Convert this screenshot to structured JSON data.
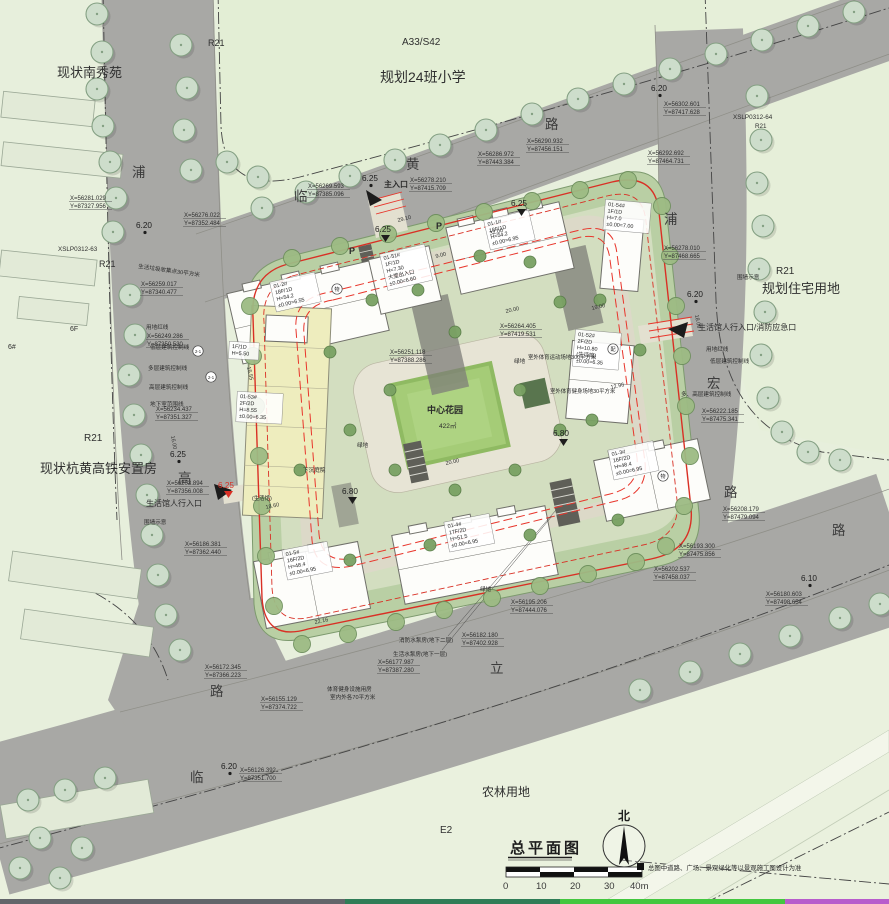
{
  "doc": {
    "title": "总平面图",
    "north_label": "北",
    "note": "总图中道路、广场、景观绿化等以景观施工图设计为准"
  },
  "scalebar": {
    "labels": [
      "0",
      "10",
      "20",
      "30",
      "40m"
    ]
  },
  "parcel_labels": [
    {
      "t": "R21",
      "x": 208,
      "y": 46,
      "s": 9
    },
    {
      "t": "现状南秀苑",
      "x": 57,
      "y": 77,
      "s": 13
    },
    {
      "t": "A33/S42",
      "x": 402,
      "y": 45,
      "s": 10
    },
    {
      "t": "规划24班小学",
      "x": 380,
      "y": 82,
      "s": 14
    },
    {
      "t": "XSLP0312-64",
      "x": 733,
      "y": 119,
      "s": 6.3
    },
    {
      "t": "R21",
      "x": 755,
      "y": 128,
      "s": 6.3
    },
    {
      "t": "R21",
      "x": 776,
      "y": 274,
      "s": 10
    },
    {
      "t": "规划住宅用地",
      "x": 762,
      "y": 293,
      "s": 13
    },
    {
      "t": "XSLP0312-63",
      "x": 58,
      "y": 251,
      "s": 6.3
    },
    {
      "t": "R21",
      "x": 99,
      "y": 267,
      "s": 9
    },
    {
      "t": "6F",
      "x": 70,
      "y": 331,
      "s": 7
    },
    {
      "t": "6#",
      "x": 8,
      "y": 349,
      "s": 7
    },
    {
      "t": "R21",
      "x": 84,
      "y": 441,
      "s": 10
    },
    {
      "t": "现状杭黄高铁安置房",
      "x": 40,
      "y": 473,
      "s": 13
    },
    {
      "t": "农林用地",
      "x": 482,
      "y": 796,
      "s": 12
    },
    {
      "t": "E2",
      "x": 440,
      "y": 833,
      "s": 10
    }
  ],
  "road_labels": [
    {
      "t": "浦",
      "x": 132,
      "y": 177
    },
    {
      "t": "临",
      "x": 294,
      "y": 201
    },
    {
      "t": "黄",
      "x": 406,
      "y": 169
    },
    {
      "t": "路",
      "x": 545,
      "y": 129
    },
    {
      "t": "浦",
      "x": 664,
      "y": 224
    },
    {
      "t": "宏",
      "x": 707,
      "y": 388
    },
    {
      "t": "路",
      "x": 724,
      "y": 497
    },
    {
      "t": "路",
      "x": 832,
      "y": 535
    },
    {
      "t": "高",
      "x": 178,
      "y": 483
    },
    {
      "t": "路",
      "x": 210,
      "y": 696
    },
    {
      "t": "临",
      "x": 190,
      "y": 782
    },
    {
      "t": "立",
      "x": 490,
      "y": 673
    }
  ],
  "annotations": [
    {
      "t": "主入口",
      "x": 384,
      "y": 187,
      "s": 8,
      "b": 1
    },
    {
      "t": "生活馆人行入口/消防应急口",
      "x": 698,
      "y": 330,
      "s": 8
    },
    {
      "t": "生活馆人行入口",
      "x": 146,
      "y": 506,
      "s": 8
    },
    {
      "t": "生活垃圾收集点30平方米",
      "x": 138,
      "y": 268,
      "s": 5.6,
      "r": 8
    },
    {
      "t": "用地红线",
      "x": 146,
      "y": 329,
      "s": 5.6
    },
    {
      "t": "低层建筑控制线",
      "x": 150,
      "y": 349,
      "s": 5.6
    },
    {
      "t": "多层建筑控制线",
      "x": 148,
      "y": 370,
      "s": 5.6
    },
    {
      "t": "高层建筑控制线",
      "x": 149,
      "y": 389,
      "s": 5.6
    },
    {
      "t": "地下室范围线",
      "x": 150,
      "y": 406,
      "s": 5.6
    },
    {
      "t": "用地红线",
      "x": 706,
      "y": 351,
      "s": 5.6
    },
    {
      "t": "低层建筑控制线",
      "x": 710,
      "y": 363,
      "s": 5.6
    },
    {
      "t": "多、高层建筑控制线",
      "x": 681,
      "y": 396,
      "s": 5.6
    },
    {
      "t": "围墙示意",
      "x": 737,
      "y": 279,
      "s": 5.6
    },
    {
      "t": "围墙示意",
      "x": 144,
      "y": 524,
      "s": 5.6
    },
    {
      "t": "室外体育运动场地300平方米",
      "x": 528,
      "y": 359,
      "s": 5.4
    },
    {
      "t": "室外体育健身场地30平方米",
      "x": 550,
      "y": 393,
      "s": 5.4
    },
    {
      "t": "体育健身设施用房",
      "x": 327,
      "y": 691,
      "s": 5.6
    },
    {
      "t": "室内外各70平方米",
      "x": 330,
      "y": 699,
      "s": 5.6
    },
    {
      "t": "消防水泵房(地下二层)",
      "x": 399,
      "y": 642,
      "s": 5.6
    },
    {
      "t": "生活水泵房(地下一层)",
      "x": 393,
      "y": 656,
      "s": 5.6
    },
    {
      "t": "下沉庭院",
      "x": 303,
      "y": 472,
      "s": 5.6
    },
    {
      "t": "中心花园",
      "x": 427,
      "y": 413,
      "s": 9,
      "b": 1
    },
    {
      "t": "422㎡",
      "x": 439,
      "y": 428,
      "s": 6.5
    },
    {
      "t": "绿地",
      "x": 514,
      "y": 363,
      "s": 5.6
    },
    {
      "t": "绿地",
      "x": 357,
      "y": 447,
      "s": 5.6
    },
    {
      "t": "绿地",
      "x": 480,
      "y": 591,
      "s": 5.6
    },
    {
      "t": "(生活馆)",
      "x": 252,
      "y": 500,
      "s": 5.4
    },
    {
      "t": "P",
      "x": 349,
      "y": 254,
      "s": 9,
      "b": 1
    },
    {
      "t": "P",
      "x": 436,
      "y": 229,
      "s": 9,
      "b": 1
    }
  ],
  "dimensions": [
    {
      "t": "29.10",
      "x": 398,
      "y": 222,
      "r": -14
    },
    {
      "t": "32.00",
      "x": 490,
      "y": 235,
      "r": -14
    },
    {
      "t": "9.00",
      "x": 436,
      "y": 258,
      "r": -14
    },
    {
      "t": "15.55",
      "x": 247,
      "y": 367,
      "r": 78
    },
    {
      "t": "20.00",
      "x": 506,
      "y": 313,
      "r": -13
    },
    {
      "t": "19.00",
      "x": 592,
      "y": 310,
      "r": -13
    },
    {
      "t": "20.00",
      "x": 446,
      "y": 465,
      "r": -13
    },
    {
      "t": "22.16",
      "x": 315,
      "y": 624,
      "r": -12
    },
    {
      "t": "18.60",
      "x": 266,
      "y": 509,
      "r": -12
    },
    {
      "t": "18.00",
      "x": 695,
      "y": 315,
      "r": 80
    },
    {
      "t": "16.00",
      "x": 171,
      "y": 436,
      "r": 80
    },
    {
      "t": "12.96",
      "x": 611,
      "y": 389,
      "r": -12
    }
  ],
  "elevations": [
    {
      "t": "6.20",
      "x": 136,
      "y": 228
    },
    {
      "t": "6.25",
      "x": 362,
      "y": 181
    },
    {
      "t": "6.20",
      "x": 651,
      "y": 91
    },
    {
      "t": "6.20",
      "x": 687,
      "y": 297
    },
    {
      "t": "6.20",
      "x": 221,
      "y": 769
    },
    {
      "t": "6.10",
      "x": 801,
      "y": 581
    },
    {
      "t": "6.25",
      "x": 170,
      "y": 457
    },
    {
      "t": "6.25",
      "x": 511,
      "y": 206,
      "tri": 1
    },
    {
      "t": "6.25",
      "x": 375,
      "y": 232,
      "tri": 1
    },
    {
      "t": "6.80",
      "x": 553,
      "y": 436,
      "tri": 1
    },
    {
      "t": "6.80",
      "x": 342,
      "y": 494,
      "tri": 1
    },
    {
      "t": "6.25",
      "x": 218,
      "y": 488,
      "c": "#d93025",
      "tri": 1
    }
  ],
  "coord_labels": [
    {
      "l1": "X=56281.029",
      "l2": "Y=87327.956",
      "x": 70,
      "y": 200
    },
    {
      "l1": "X=56276.022",
      "l2": "Y=87352.484",
      "x": 184,
      "y": 217
    },
    {
      "l1": "X=56269.593",
      "l2": "Y=87385.096",
      "x": 308,
      "y": 188
    },
    {
      "l1": "X=56278.210",
      "l2": "Y=87415.709",
      "x": 410,
      "y": 182
    },
    {
      "l1": "X=56286.972",
      "l2": "Y=87443.384",
      "x": 478,
      "y": 156
    },
    {
      "l1": "X=56290.932",
      "l2": "Y=87456.151",
      "x": 527,
      "y": 143
    },
    {
      "l1": "X=56302.601",
      "l2": "Y=87417.628",
      "x": 664,
      "y": 106
    },
    {
      "l1": "X=56292.692",
      "l2": "Y=87464.731",
      "x": 648,
      "y": 155
    },
    {
      "l1": "X=56278.010",
      "l2": "Y=87468.665",
      "x": 664,
      "y": 250
    },
    {
      "l1": "X=56222.185",
      "l2": "Y=87475.341",
      "x": 702,
      "y": 413
    },
    {
      "l1": "X=56208.179",
      "l2": "Y=87479.094",
      "x": 723,
      "y": 511
    },
    {
      "l1": "X=56193.300",
      "l2": "Y=87475.856",
      "x": 679,
      "y": 548
    },
    {
      "l1": "X=56180.603",
      "l2": "Y=87498.654",
      "x": 766,
      "y": 596
    },
    {
      "l1": "X=56202.537",
      "l2": "Y=87458.037",
      "x": 654,
      "y": 571
    },
    {
      "l1": "X=56195.206",
      "l2": "Y=87444.076",
      "x": 511,
      "y": 604
    },
    {
      "l1": "X=56182.180",
      "l2": "Y=87402.928",
      "x": 462,
      "y": 637
    },
    {
      "l1": "X=56177.987",
      "l2": "Y=87387.280",
      "x": 378,
      "y": 664
    },
    {
      "l1": "X=56172.345",
      "l2": "Y=87366.223",
      "x": 205,
      "y": 669
    },
    {
      "l1": "X=56155.129",
      "l2": "Y=87374.722",
      "x": 261,
      "y": 701
    },
    {
      "l1": "X=56186.381",
      "l2": "Y=87362.440",
      "x": 185,
      "y": 546
    },
    {
      "l1": "X=56259.017",
      "l2": "Y=87340.477",
      "x": 141,
      "y": 286
    },
    {
      "l1": "X=56249.286",
      "l2": "Y=87350.530",
      "x": 147,
      "y": 338
    },
    {
      "l1": "X=56234.437",
      "l2": "Y=87351.327",
      "x": 156,
      "y": 411
    },
    {
      "l1": "X=56203.894",
      "l2": "Y=87356.008",
      "x": 167,
      "y": 485
    },
    {
      "l1": "X=56126.392",
      "l2": "Y=87351.700",
      "x": 240,
      "y": 772
    },
    {
      "l1": "X=56264.405",
      "l2": "Y=87419.531",
      "x": 500,
      "y": 328
    },
    {
      "l1": "X=56251.118",
      "l2": "Y=87388.286",
      "x": 390,
      "y": 354
    }
  ],
  "buildings": [
    {
      "id": "01-2",
      "lines": [
        "01-2#",
        "18F/1D",
        "H=54.2",
        "±0.00=6.55"
      ],
      "x": 274,
      "y": 288,
      "r": -13
    },
    {
      "id": "01-1",
      "lines": [
        "01-1#",
        "18F/1D",
        "H=54.2",
        "±0.00=6.95"
      ],
      "x": 488,
      "y": 226,
      "r": -13
    },
    {
      "id": "01-51",
      "lines": [
        "01-51#",
        "1F/1D",
        "H=7.30",
        "大堂出入口",
        "±0.00=6.60"
      ],
      "x": 384,
      "y": 260,
      "r": -13
    },
    {
      "id": "01-54",
      "lines": [
        "01-54#",
        "1F/1D",
        "H=7.0",
        "±0.00=7.00"
      ],
      "x": 608,
      "y": 206,
      "r": 5
    },
    {
      "id": "01-52",
      "lines": [
        "01-52#",
        "2F/2D",
        "H=10.80",
        "(生活馆)",
        "±0.00=6.35"
      ],
      "x": 578,
      "y": 336,
      "r": 5
    },
    {
      "id": "01-3",
      "lines": [
        "01-3#",
        "16F/2D",
        "H=48.4",
        "±0.00=6.95"
      ],
      "x": 612,
      "y": 456,
      "r": -12
    },
    {
      "id": "01-4",
      "lines": [
        "01-4#",
        "17F/2D",
        "H=51.5",
        "±0.00=6.95"
      ],
      "x": 448,
      "y": 528,
      "r": -11
    },
    {
      "id": "01-5",
      "lines": [
        "01-5#",
        "16F/2D",
        "H=48.4",
        "±0.00=6.95"
      ],
      "x": 286,
      "y": 556,
      "r": -11
    },
    {
      "id": "01-53",
      "lines": [
        "01-53#",
        "2F/2D",
        "H=8.55",
        "±0.00=6.35"
      ],
      "x": 240,
      "y": 398,
      "r": 3
    },
    {
      "id": "01-53a",
      "lines": [
        "1F/1D",
        "H=5.50"
      ],
      "x": 232,
      "y": 348,
      "r": 3
    }
  ],
  "circle_markers": [
    {
      "t": "物",
      "x": 337,
      "y": 289
    },
    {
      "t": "配",
      "x": 613,
      "y": 349
    },
    {
      "t": "物",
      "x": 663,
      "y": 476
    },
    {
      "t": "2-1",
      "x": 198,
      "y": 351
    },
    {
      "t": "2-1",
      "x": 211,
      "y": 377
    }
  ]
}
